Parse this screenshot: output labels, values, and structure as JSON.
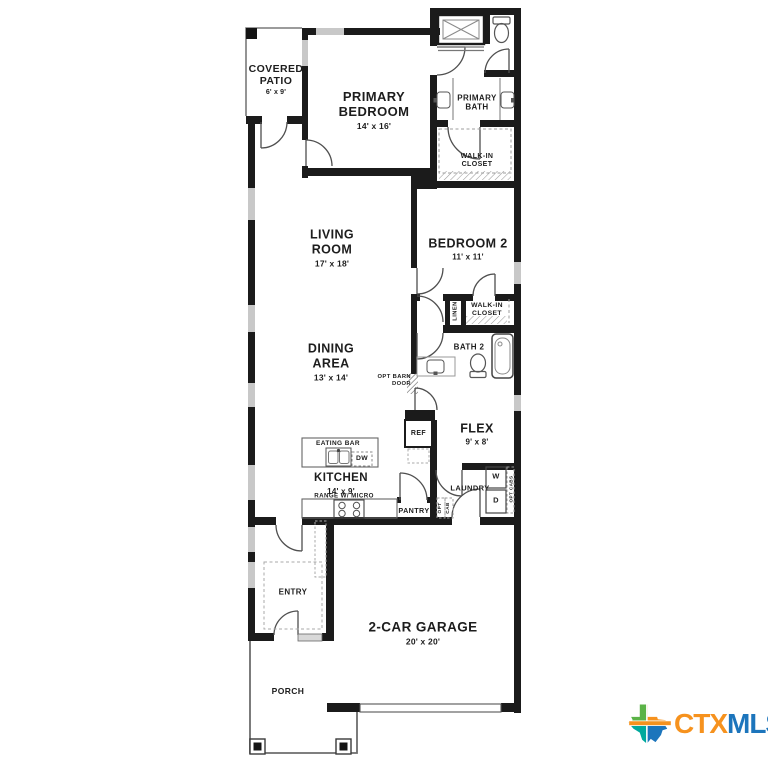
{
  "rooms": {
    "covered_patio": {
      "name": "COVERED PATIO",
      "dims": "6' x 9'"
    },
    "primary_bedroom": {
      "name": "PRIMARY BEDROOM",
      "dims": "14' x 16'"
    },
    "primary_bath": {
      "name": "PRIMARY BATH"
    },
    "walk_in_closet_primary": {
      "name": "WALK-IN CLOSET"
    },
    "living_room": {
      "name": "LIVING ROOM",
      "dims": "17' x 18'"
    },
    "bedroom_2": {
      "name": "BEDROOM 2",
      "dims": "11' x 11'"
    },
    "linen": {
      "name": "LINEN"
    },
    "walk_in_closet_2": {
      "name": "WALK-IN CLOSET"
    },
    "bath_2": {
      "name": "BATH 2"
    },
    "dining_area": {
      "name": "DINING AREA",
      "dims": "13' x 14'"
    },
    "flex": {
      "name": "FLEX",
      "dims": "9' x 8'"
    },
    "kitchen": {
      "name": "KITCHEN",
      "dims": "14' x 9'",
      "note": "RANGE W/ MICRO"
    },
    "laundry": {
      "name": "LAUNDRY"
    },
    "entry": {
      "name": "ENTRY"
    },
    "garage": {
      "name": "2-CAR GARAGE",
      "dims": "20' x 20'"
    },
    "porch": {
      "name": "PORCH"
    }
  },
  "features": {
    "eating_bar": "EATING BAR",
    "dishwasher": "DW",
    "refrigerator": "REF",
    "pantry": "PANTRY",
    "washer": "W",
    "dryer": "D",
    "opt_barn_door": "OPT BARN DOOR",
    "opt_cab_word1": "OPT",
    "opt_cab_word2": "CAB",
    "opt_cabs": "OPT CABS"
  },
  "logo": {
    "ctx": "CTX",
    "mls": "MLS",
    "ctx_color": "#F6921E",
    "mls_color": "#1C75BC"
  }
}
